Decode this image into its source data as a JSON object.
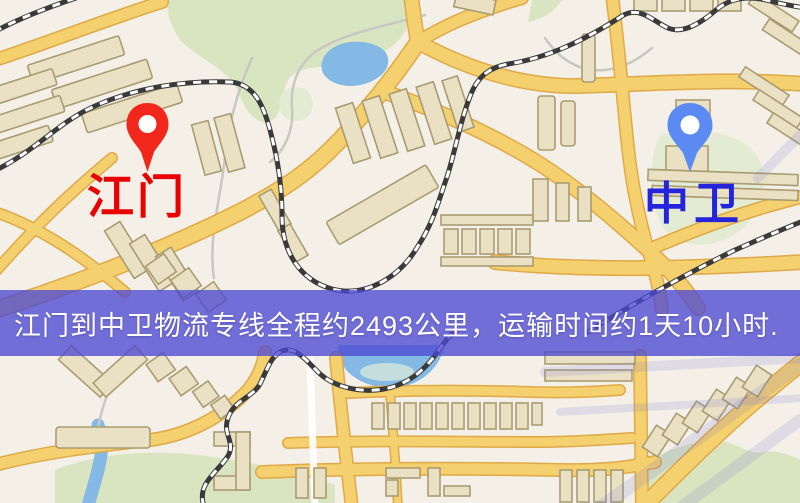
{
  "map": {
    "origin": {
      "label": "江门"
    },
    "destination": {
      "label": "中卫"
    },
    "route": {
      "distance_km": 2493,
      "duration_text": "1天10小时"
    }
  },
  "banner": {
    "text": "江门到中卫物流专线全程约2493公里，运输时间约1天10小时."
  },
  "colors": {
    "map-bg": "#f4f0e8",
    "road-fill": "#f5d06e",
    "road-casing": "#dfa947",
    "road-white": "#ffffff",
    "building-fill": "#eae1c4",
    "building-stroke": "#a99c72",
    "green": "#d9e5c0",
    "green-light": "#e3ecd3",
    "water": "#84b9e6",
    "water-light": "#cfe3da",
    "rail-base": "#3a3a3a",
    "rail-dash": "#ffffff",
    "stream": "#c8c8c2",
    "pin-red": "#f2271c",
    "pin-blue": "#5b8bf2",
    "label-red": "#e80202",
    "label-blue": "#2424dc",
    "banner-bg": "rgba(77,73,210,0.78)",
    "banner-text": "#ffffff",
    "watermark": "rgba(110,110,215,0.16)"
  }
}
